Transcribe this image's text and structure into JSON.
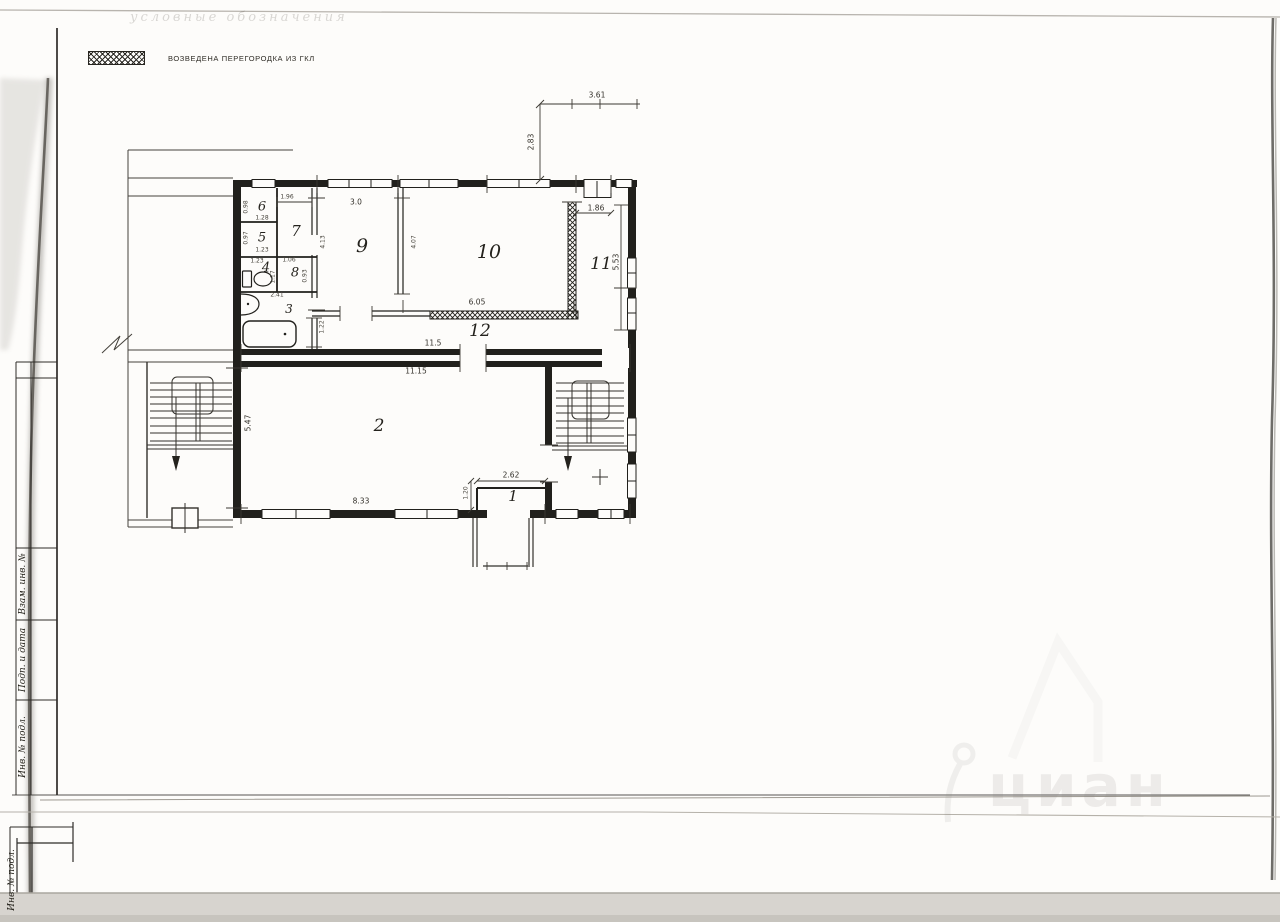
{
  "header": {
    "faint_title": "условные обозначения"
  },
  "legend": {
    "hatch_label": "ВОЗВЕДЕНА ПЕРЕГОРОДКА ИЗ ГКЛ"
  },
  "plan": {
    "rooms": {
      "n1": "1",
      "n2": "2",
      "n3": "3",
      "n4": "4",
      "n5": "5",
      "n6": "6",
      "n7": "7",
      "n8": "8",
      "n9": "9",
      "n10": "10",
      "n11": "11",
      "n12": "12"
    },
    "dims": {
      "a361": "3.61",
      "a283": "2.83",
      "a196": "1.96",
      "a30": "3.0",
      "a186": "1.86",
      "a413": "4.13",
      "a407": "4.07",
      "a553": "5.53",
      "a605": "6.05",
      "a115": "11.5",
      "a1115": "11.15",
      "a547": "5.47",
      "a262": "2.62",
      "a120": "1.20",
      "a833": "8.33",
      "a122": "1.22",
      "r6w": "1.28",
      "r6h": "0.98",
      "r5w": "1.23",
      "r5h": "0.97",
      "r4w": "1.23",
      "r4h": "1.17",
      "r8w": "1.06",
      "r8h": "0.93",
      "r3w": "2.41"
    }
  },
  "title_block": {
    "vzam": "Взам. инв. №",
    "podp": "Подп. и дата",
    "inv": "Инв. № подл.",
    "inv2": "Инв. № подл."
  },
  "watermark": {
    "text": "циан"
  },
  "colors": {
    "wall": "#21201c",
    "paper": "#fdfcfa",
    "scan_band": "#d7d4cf"
  }
}
